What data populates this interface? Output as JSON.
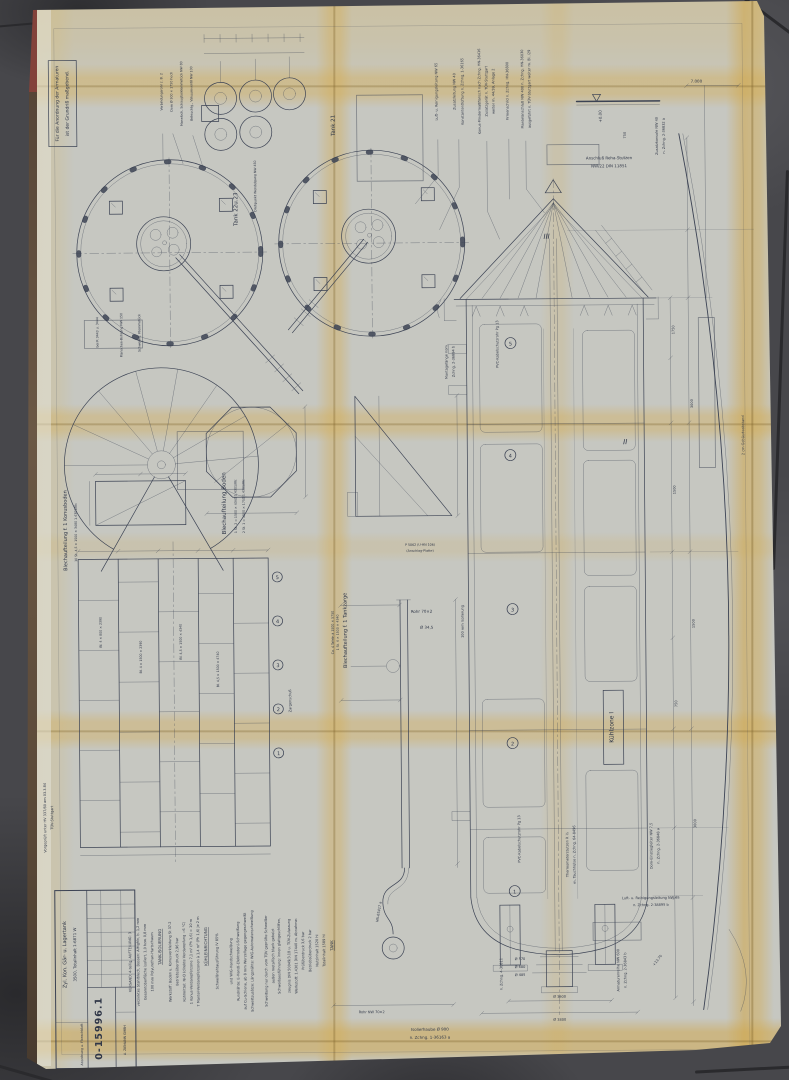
{
  "titleblock": {
    "number": "0-15996.1",
    "title1": "Zyl. Kon. Gär- u. Lagertank",
    "title2": "3500, Totalinhalt 1-6871 W",
    "doc_type": "Anordnung u. Flanschblatt",
    "company": "A. ZIEMANN GMBH"
  },
  "corner_note": {
    "l1": "Für die Anordnung der Armaturen",
    "l2": "ist der Grundriß maßgebend."
  },
  "tl_items": [
    "Verbindungsrohr z. B. 2",
    "Dom Ø 500 × 1750 hoch",
    "Mannloch, Schauglasklemmstück NW 80",
    "Beleuchtg., Vakuumventil NW 100"
  ],
  "plans": {
    "tank2223": "Tank 22u.23",
    "tank21": "Tank 21",
    "pivot": "Drehpunkt Wendelgang NW 450",
    "below1": "Schwenkb. Klemmstück",
    "below2": "Flanschen-Bohrung NW 150",
    "below3": "bei R 3443 u. 3444"
  },
  "top_notes": [
    "Luft- u. Reinigungsleitung NW 65",
    "Zusatzleitung NW 40",
    "Konstantentlüftung n. Zchng. 1-36165",
    "Konus-Mindermaßflansch nach Zchng. HN-36416",
    "Zusatzgerät n. TÜV-Stuttgart",
    "weiter m. 44/39, Anlage 2",
    "Firmenschild n. Zchng. HN-36800",
    "Mantelanschluß NW 400 n. Zchng. HN-36030",
    "ausgeführt n. TÜV-Stuttgart weiter m. Bl. /29"
  ],
  "top_right": {
    "level": "+0.00",
    "dim750": "750",
    "stutzen1": "Anschluß Reha-Stutzen",
    "stutzen2": "NW/22 DIN 11851",
    "konsole1": "Zusatzkonsole NW 40",
    "konsole2": "n. Zchng. 2-36832 a",
    "dim7000": "7.000"
  },
  "sheet_layouts": {
    "boden_title": "Blechaufteilung Boden",
    "boden_l1": "1 St. 2 = 1500 × 4340   1.4301/IIIc",
    "boden_l2": "2 St. 1 = 1500 × 1750   1.4301/IIIc",
    "konus_title": "Blechaufteilung f. 1 Konusboden",
    "konus_l1": "10 St. 4,5 × 1500 × 3480   1.4301/IIIc",
    "zarge_title": "Blechaufteilung f. 1 Tankzarge",
    "zarge_l1": "Ca. 4 Tafeln à 1500 × 5750",
    "zarge_l2": "1 St. 4 × 1500 × 4340",
    "zargenschuss": "Zargenschuß",
    "plate1": "Bl. 4 × 800 × 2390",
    "plate2": "Bl. 4 × 1500 × 2390",
    "plate3": "Bl. 4,5 × 1500 × 4340",
    "plate4": "Bl. 4,5 × 1500 × 4740",
    "ring_numbers": [
      "5",
      "4",
      "3",
      "2",
      "1"
    ]
  },
  "pipe_detail": {
    "rohr": "Rohr 70×2",
    "dia": "Ø 34,5",
    "isolierung": "100 mm Isolierung",
    "zchng": "HN-65417 a",
    "rohr2": "Rohr NW 70×2",
    "fuge1": "P 5062 (U-HN 106)",
    "fuge2": "(Anschlag-Platte)"
  },
  "elevation": {
    "kuehlzone": "Kühlzone I",
    "roman2": "II",
    "roman3": "III",
    "sections": [
      "5",
      "4",
      "3",
      "2",
      "1"
    ],
    "kabel": "PVC-Kabelschutzrohr Pg 13",
    "montage1": "Montagelänge nom.",
    "montage2": "Zchng. 2-36894 b",
    "leiter1": "Dom-Einstiegleiter NW 7,5",
    "leiter2": "n. Zchng. 2-36848 a",
    "thermo1": "Thermometerstutzen R ½",
    "thermo2": "m. Tauchhülse n. Zchng. 64-8496",
    "armaturen1": "Armaturenreihe NW 600",
    "armaturen2": "n. Zchng. 2-36843 b",
    "zchng4": "n. Zchng. 4-36811",
    "level1370": "+13.70",
    "luft1": "Luft- u. Reinigungsleitung NW 65",
    "luft2": "n. Zchng. 2-38895 b",
    "haube1": "Isolierhaube Ø 900",
    "haube2": "n. Zchng. 1-36163 a",
    "d570": "Ø 570",
    "d680": "Ø 680",
    "d485": "Ø 485",
    "d3600": "Ø 3600",
    "d3800": "Ø 3800",
    "dims": [
      "1750",
      "1500",
      "3000",
      "1500",
      "750",
      "3000"
    ],
    "abstand": "2 cm Gebäudeabstand"
  },
  "bottom_notes": [
    "Schweißung nur durch vom TÜV geprüfte Schweißer",
    "Schweißzusätze: Längsnähte: WIG-Automatenschweißung",
    "auf Cu-Schiene, ab 8 mm Wurzellage gegengeschweißt",
    "Rundnähte: E-Hand(-Elektroden)-Schweißung",
    "und WIG-Handschweißung",
    "Schweißnahtausführung IV 85%",
    "KÜHLEINRICHTUNG",
    "7 Mantel-Verdampferzonen à 1,4 m² (Ph 1,6) je 2 m",
    "1 Konus-Verdampferzone 7,1 m² (Ph 1,6) = 10 m",
    "Kühlmittel: NH3 (direkte Verdampfung −6 °C)",
    "Betriebsüberdruck 2,96 bar",
    "Werkstoff: Boden u. Konusverkleidung St 37-2",
    "TANK-ISOLIERUNG",
    "100 mm Polyurethan-Hartschaum",
    "Gesamtoberfläche isoliert, 1,0 bzw. 0,8 mm",
    "verzinktes Stahlblech, Bossen: AlMgMn, b. 1,2 mm",
    "VERSAND: 4-teilig, AUFTEILUNG: 3"
  ],
  "tank_data": [
    "TANK",
    "Totalinhalt 1589 hl",
    "Nutzinhalt 1520 hl",
    "Betriebsüberdruck 2 bar",
    "Prüfüberdruck 3,6 bar",
    "Werkstoff: 1.4301 DIN 17440 m. Abnahme-",
    "zeugnis DIN 50049/3.1B u. TÜV-Zulassung",
    "Schweißausführung: innen glattgeschliffen,",
    "außen metallisch blank gebeizt"
  ],
  "pruef": {
    "l1": "Vorgeprüft unter HV 337/80 am 03.3.84",
    "l2": "TÜV-Stuttgart"
  }
}
